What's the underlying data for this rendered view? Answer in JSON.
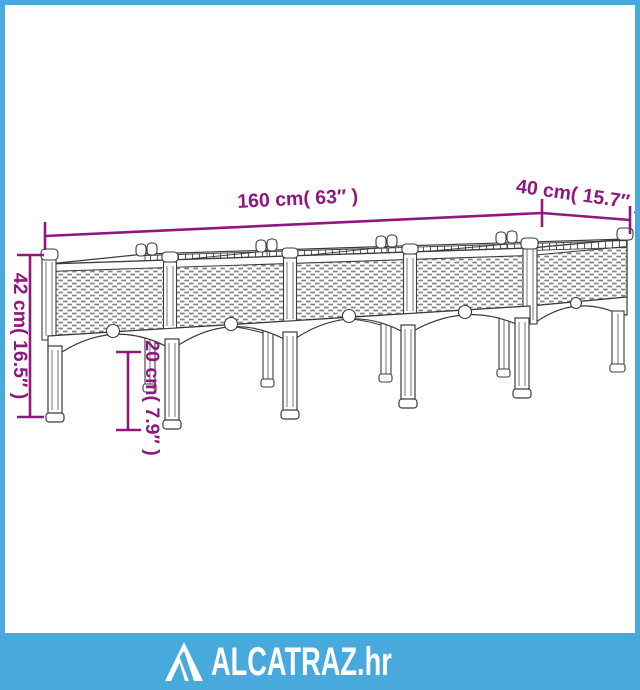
{
  "page": {
    "background": "#ffffff",
    "frame_color": "#48a9dc"
  },
  "diagram": {
    "subject": "raised garden planter with legs, 4 rattan-weave sections, arched skirt",
    "dimension_color": "#8e187e",
    "line_color": "#3b3b3b",
    "dimensions": {
      "length": {
        "label": "160 cm( 63″ )",
        "cm": 160,
        "inches": 63
      },
      "depth": {
        "label": "40 cm( 15.7″ )",
        "cm": 40,
        "inches": 15.7
      },
      "height": {
        "label": "42 cm( 16.5″ )",
        "cm": 42,
        "inches": 16.5
      },
      "leg_height": {
        "label": "20 cm( 7.9″ )",
        "cm": 20,
        "inches": 7.9
      }
    }
  },
  "footer": {
    "background": "#48a9dc",
    "brand": "ALCATRAZ.hr",
    "icon": "alcatraz-triangle-logo"
  }
}
